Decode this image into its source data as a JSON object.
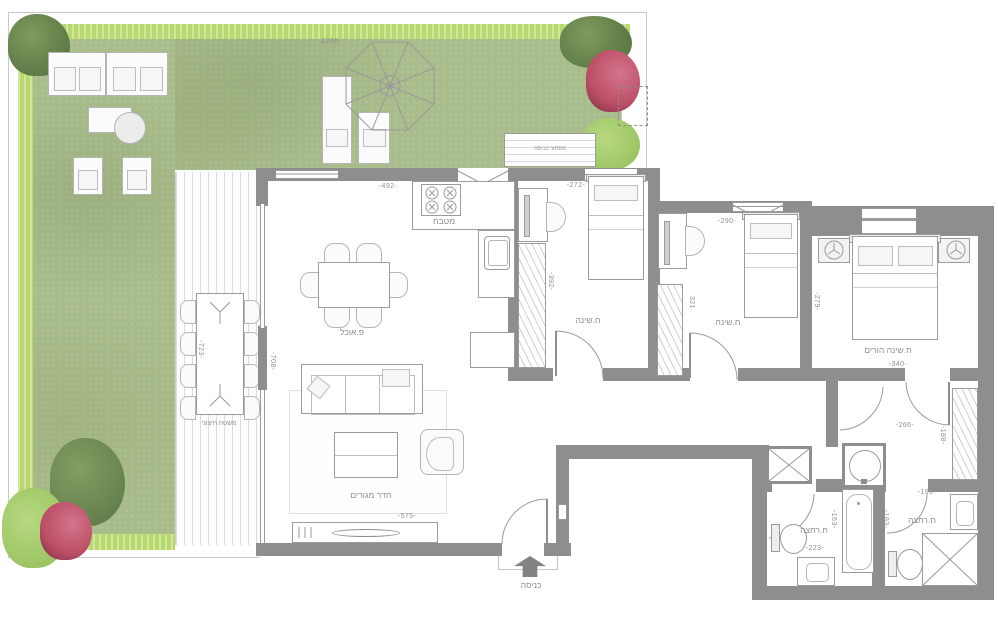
{
  "plan": {
    "labels": {
      "kitchen": "מטבח",
      "dining": "פ.אוכל",
      "living": "חדר מגורים",
      "deck": "משטח חיצוני",
      "laundry_screen": "מסתור כביסה",
      "bedroom1": "ח.שינה",
      "bedroom2": "ח.שינה",
      "master_bedroom": "ח.שינה הורים",
      "bathroom1": "ח.רחצה",
      "bathroom2": "ח.רחצה",
      "entrance": "כניסה"
    },
    "dimensions": {
      "garden_width": "-1266-",
      "kitchen_width": "-492-",
      "living_width": "-575-",
      "living_depth": "-708-",
      "deck_length": "-723-",
      "bedroom1_width": "-272-",
      "bedroom1_depth": "-392-",
      "bedroom2_width": "-290-",
      "bedroom2_depth": "321",
      "master_width": "-340-",
      "master_depth": "-279-",
      "hall_width": "-266-",
      "hall_depth": "-188-",
      "bathroom1_width": "-223-",
      "bathroom1_depth": "-163-",
      "bathroom2_width": "-199-",
      "bathroom2_depth": "-183-"
    },
    "colors": {
      "wall": "#8e8e8e",
      "fline": "#9b9b9b",
      "grass": "#a9bc8b",
      "hedge": "#b9d96f",
      "text": "#8f8f8f",
      "tree": "#5e7a46",
      "bush": "#9cc463",
      "flower": "#bb4f66"
    }
  }
}
